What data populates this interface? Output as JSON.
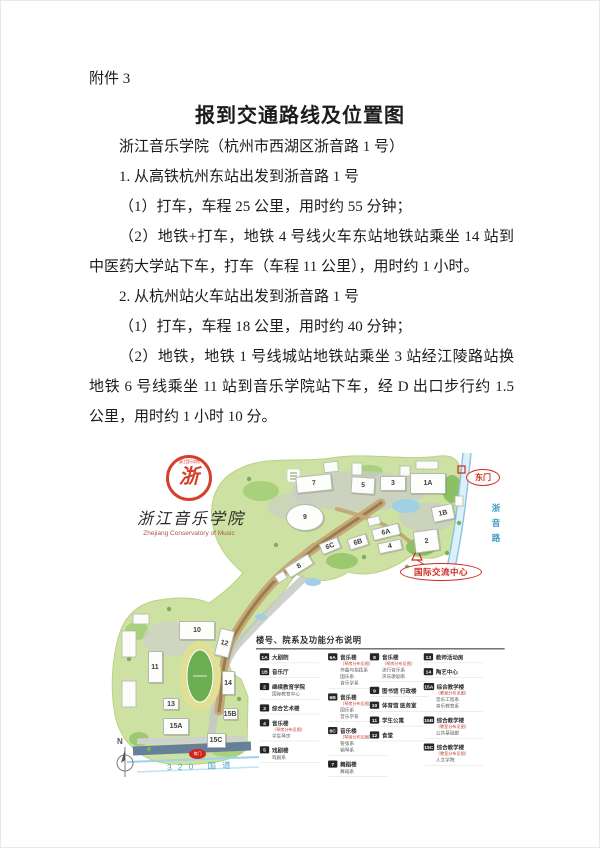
{
  "doc": {
    "attachment_label": "附件 3",
    "title": "报到交通路线及位置图",
    "paragraphs": [
      "浙江音乐学院（杭州市西湖区浙音路 1 号）",
      "1. 从高铁杭州东站出发到浙音路 1 号",
      "（1）打车，车程 25 公里，用时约 55 分钟；",
      "（2）地铁+打车，地铁 4 号线火车东站地铁站乘坐 14 站到中医药大学站下车，打车（车程 11 公里），用时约 1 小时。",
      "2. 从杭州站火车站出发到浙音路 1 号",
      "（1）打车，车程 18 公里，用时约 40 分钟；",
      "（2）地铁，地铁 1 号线城站地铁站乘坐 3 站经江陵路站换地铁 6 号线乘坐 11 站到音乐学院站下车，经 D 出口步行约 1.5 公里，用时约 1 小时 10 分。"
    ]
  },
  "map": {
    "logo": {
      "cn_name": "浙江音乐学院",
      "en_name": "Zhejiang Conservatory of Music",
      "seal_ring_text": "浙江音乐学院",
      "seal_mark": "浙",
      "seal_color": "#d5402e"
    },
    "annotations": {
      "east_gate": "东门",
      "zheyin_road": "浙音路",
      "intl_center": "国际交流中心",
      "south_gate": "南门",
      "route_320": "320 国道",
      "compass_north": "N"
    },
    "colors": {
      "campus_green": "#cde2a2",
      "accent_red": "#cf2b20",
      "road_blue_text": "#49a8cc"
    },
    "buildings": [
      {
        "id": "7",
        "x": 205,
        "y": 34,
        "w": 36,
        "h": 17,
        "r": -6
      },
      {
        "id": "5",
        "x": 254,
        "y": 36,
        "w": 24,
        "h": 17,
        "r": 4
      },
      {
        "id": "3",
        "x": 284,
        "y": 34,
        "w": 26,
        "h": 15,
        "r": 0
      },
      {
        "id": "1A",
        "x": 319,
        "y": 34,
        "w": 36,
        "h": 21,
        "r": 0
      },
      {
        "id": "1B",
        "x": 334,
        "y": 64,
        "w": 22,
        "h": 16,
        "r": -12
      },
      {
        "id": "9",
        "x": 196,
        "y": 68,
        "w": 38,
        "h": 27,
        "r": 0,
        "shape": "ellipse"
      },
      {
        "id": "6A",
        "x": 277,
        "y": 83,
        "w": 28,
        "h": 12,
        "r": -14
      },
      {
        "id": "6B",
        "x": 249,
        "y": 93,
        "w": 20,
        "h": 12,
        "r": -18
      },
      {
        "id": "6C",
        "x": 221,
        "y": 97,
        "w": 20,
        "h": 12,
        "r": -22
      },
      {
        "id": "4",
        "x": 281,
        "y": 97,
        "w": 24,
        "h": 11,
        "r": -12
      },
      {
        "id": "2",
        "x": 317,
        "y": 92,
        "w": 25,
        "h": 22,
        "r": -8
      },
      {
        "id": "8",
        "x": 190,
        "y": 117,
        "w": 28,
        "h": 12,
        "r": -32
      },
      {
        "id": "10",
        "x": 88,
        "y": 181,
        "w": 36,
        "h": 19,
        "r": 0
      },
      {
        "id": "12",
        "x": 115,
        "y": 194,
        "w": 15,
        "h": 28,
        "r": 14
      },
      {
        "id": "11",
        "x": 46,
        "y": 218,
        "w": 15,
        "h": 32,
        "r": 0
      },
      {
        "id": "14",
        "x": 119,
        "y": 234,
        "w": 13,
        "h": 24,
        "r": 0
      },
      {
        "id": "13",
        "x": 62,
        "y": 255,
        "w": 16,
        "h": 12,
        "r": 0
      },
      {
        "id": "15B",
        "x": 121,
        "y": 265,
        "w": 15,
        "h": 12,
        "r": 0
      },
      {
        "id": "15A",
        "x": 67,
        "y": 277,
        "w": 26,
        "h": 17,
        "r": 0
      },
      {
        "id": "15C",
        "x": 107,
        "y": 291,
        "w": 19,
        "h": 15,
        "r": 0
      }
    ],
    "legend": {
      "title": "楼号、院系及功能分布说明",
      "columns": [
        [
          {
            "num": "1A",
            "name": "大剧院"
          },
          {
            "num": "1B",
            "name": "音乐厅"
          },
          {
            "num": "2",
            "name": "继续教育学院",
            "subs": [
              "国际教育中心"
            ]
          },
          {
            "num": "3",
            "name": "综合艺术楼"
          },
          {
            "num": "4",
            "name": "音乐楼",
            "note": "（琴房分布见图）",
            "subs": [
              "学生琴房"
            ]
          },
          {
            "num": "5",
            "name": "戏剧楼",
            "subs": [
              "戏剧系"
            ]
          }
        ],
        [
          {
            "num": "6A",
            "name": "音乐楼",
            "note": "（琴房分布见图）",
            "subs": [
              "作曲与指挥系",
              "国乐系",
              "音乐学系"
            ]
          },
          {
            "num": "6B",
            "name": "音乐楼",
            "note": "（琴房分布见图）",
            "subs": [
              "国乐系",
              "音乐学系"
            ]
          },
          {
            "num": "6C",
            "name": "音乐楼",
            "note": "（琴房分布见图）",
            "subs": [
              "管弦系",
              "钢琴系"
            ]
          },
          {
            "num": "7",
            "name": "舞蹈楼",
            "subs": [
              "舞蹈系"
            ]
          }
        ],
        [
          {
            "num": "8",
            "name": "音乐楼",
            "note": "（琴房分布见图）",
            "subs": [
              "流行音乐系",
              "声乐歌剧系"
            ]
          },
          {
            "num": "9",
            "name": "图书馆 行政楼"
          },
          {
            "num": "10",
            "name": "体育馆 医务室"
          },
          {
            "num": "11",
            "name": "学生公寓"
          },
          {
            "num": "12",
            "name": "食堂"
          }
        ],
        [
          {
            "num": "13",
            "name": "教师活动房"
          },
          {
            "num": "14",
            "name": "陶艺中心"
          },
          {
            "num": "15A",
            "name": "综合教学楼",
            "note": "（教室分布见图）",
            "subs": [
              "音乐工程系",
              "音乐教育系"
            ]
          },
          {
            "num": "15B",
            "name": "综合教学楼",
            "note": "（教室分布见图）",
            "subs": [
              "公共基础部"
            ]
          },
          {
            "num": "15C",
            "name": "综合教学楼",
            "note": "（教室分布见图）",
            "subs": [
              "人文学院"
            ]
          }
        ]
      ]
    }
  }
}
